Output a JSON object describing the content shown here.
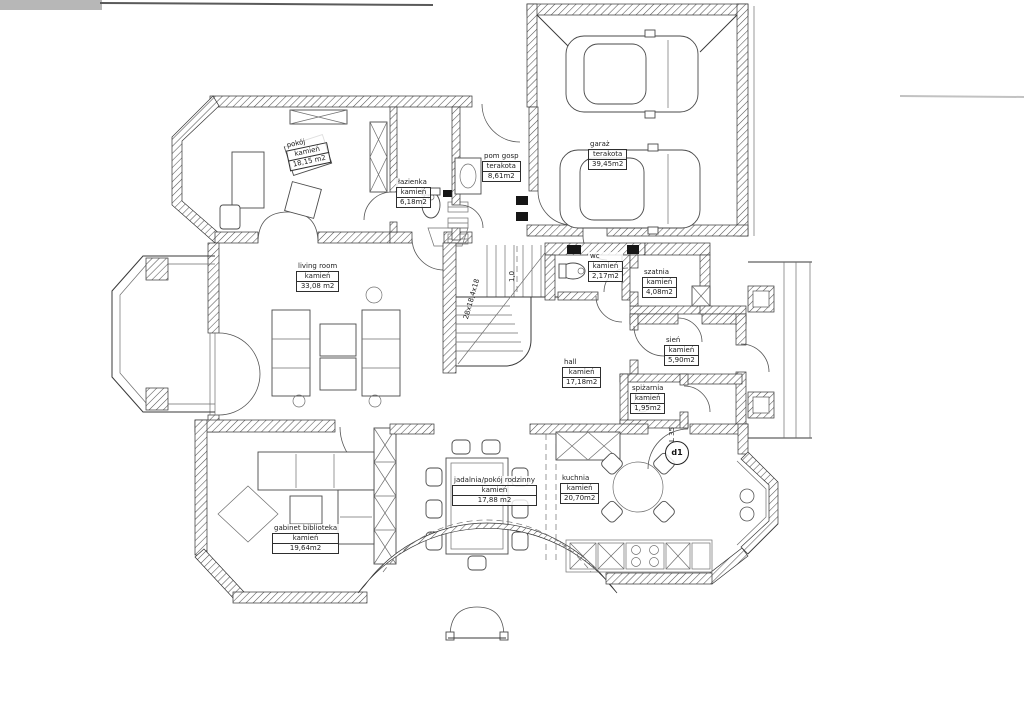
{
  "document": {
    "type": "architectural floor plan (ground floor, scanned)",
    "ink_color": "#3a3a3a",
    "paper_color": "#ffffff"
  },
  "rooms": [
    {
      "id": "pokoj",
      "name": "pokój",
      "material": "kamień",
      "area": "18,15 m2"
    },
    {
      "id": "lazienka",
      "name": "łazienka",
      "material": "kamień",
      "area": "6,18m2"
    },
    {
      "id": "pom_gosp",
      "name": "pom gosp",
      "material": "terakota",
      "area": "8,61m2"
    },
    {
      "id": "garaz",
      "name": "garaż",
      "material": "terakota",
      "area": "39,45m2"
    },
    {
      "id": "living",
      "name": "living room",
      "material": "kamień",
      "area": "33,08 m2"
    },
    {
      "id": "wc",
      "name": "wc",
      "material": "kamień",
      "area": "2,17m2"
    },
    {
      "id": "szatnia",
      "name": "szatnia",
      "material": "kamień",
      "area": "4,08m2"
    },
    {
      "id": "sien",
      "name": "sień",
      "material": "kamień",
      "area": "5,90m2"
    },
    {
      "id": "hall",
      "name": "hall",
      "material": "kamień",
      "area": "17,18m2"
    },
    {
      "id": "spizarnia",
      "name": "spiżarnia",
      "material": "kamień",
      "area": "1,95m2"
    },
    {
      "id": "jadalnia",
      "name": "jadalnia/pokój rodzinny",
      "material": "kamień",
      "area": "17,88 m2"
    },
    {
      "id": "kuchnia",
      "name": "kuchnia",
      "material": "kamień",
      "area": "20,70m2"
    },
    {
      "id": "gabinet",
      "name": "gabinet biblioteka",
      "material": "kamień",
      "area": "19,64m2"
    }
  ],
  "annotations": {
    "stairs": "28x18,4x18",
    "stair_width": "1,0",
    "door": "d1",
    "lintel": "L 35"
  }
}
